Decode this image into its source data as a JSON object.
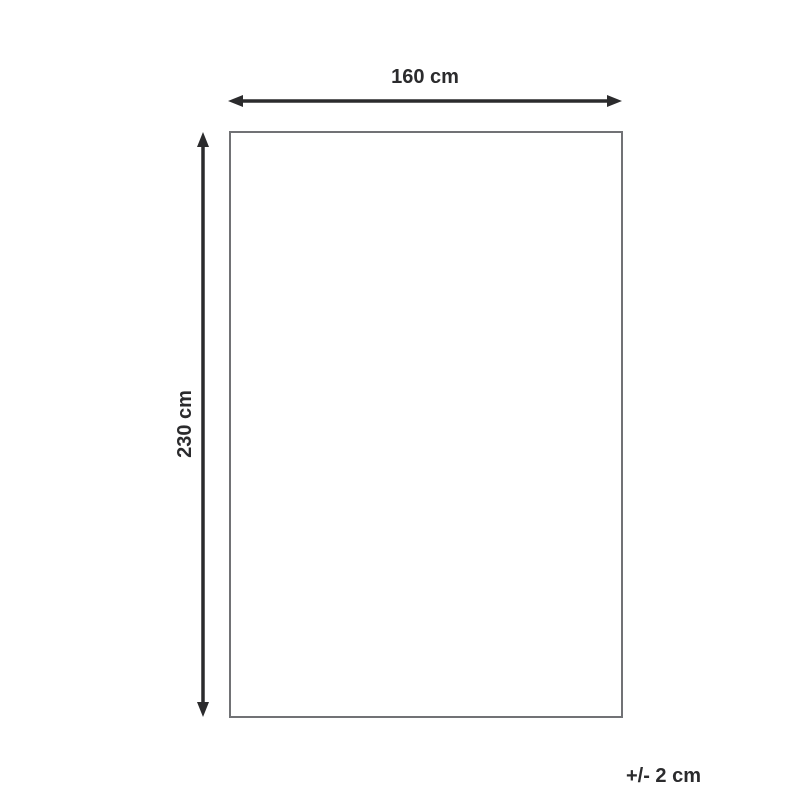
{
  "diagram": {
    "width_label": "160 cm",
    "height_label": "230 cm",
    "tolerance_label": "+/- 2 cm",
    "colors": {
      "background": "#ffffff",
      "arrow": "#2b2b2d",
      "outline_border": "#717275",
      "text": "#2b2b2d"
    }
  }
}
